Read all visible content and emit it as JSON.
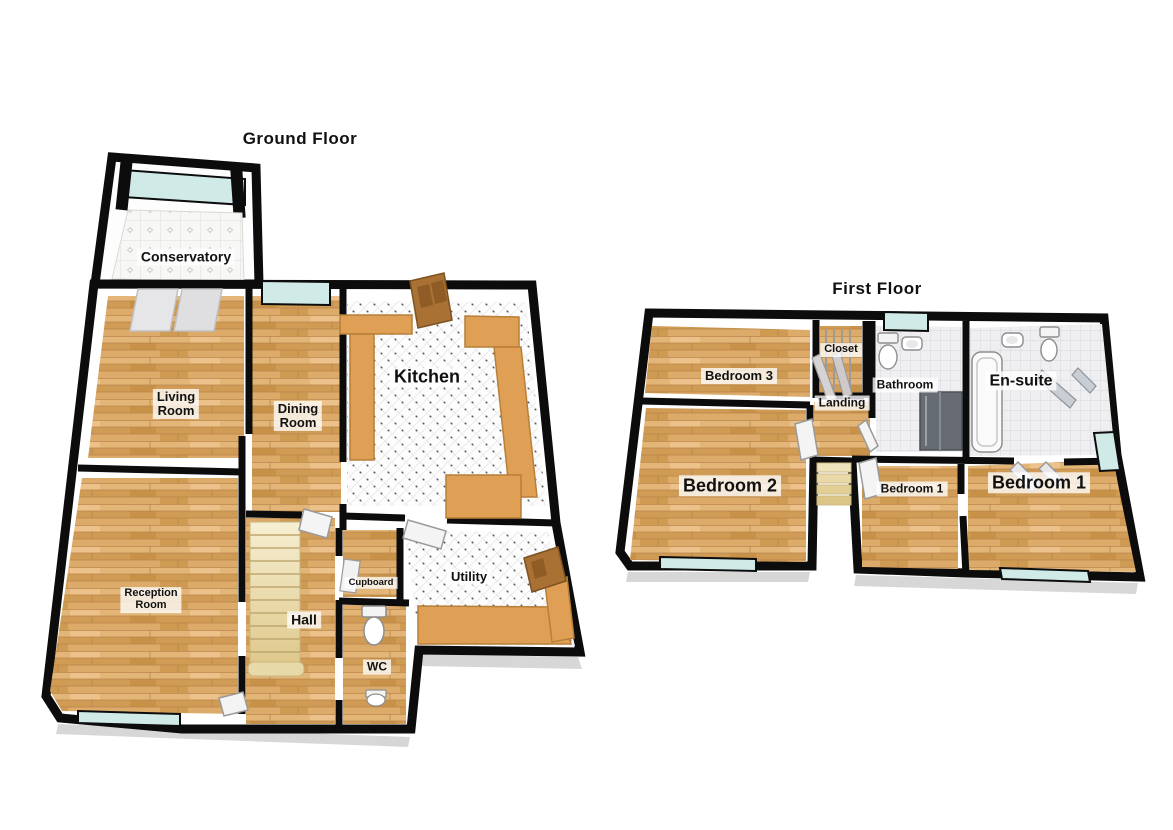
{
  "canvas": {
    "width": 1173,
    "height": 830,
    "background": "#ffffff"
  },
  "floors": [
    {
      "id": "ground-floor",
      "title": "Ground Floor",
      "rooms": [
        {
          "id": "conservatory",
          "label": "Conservatory"
        },
        {
          "id": "living-room",
          "label": "Living\nRoom"
        },
        {
          "id": "dining-room",
          "label": "Dining\nRoom"
        },
        {
          "id": "kitchen",
          "label": "Kitchen"
        },
        {
          "id": "reception-room",
          "label": "Reception\nRoom"
        },
        {
          "id": "hall",
          "label": "Hall"
        },
        {
          "id": "cupboard",
          "label": "Cupboard"
        },
        {
          "id": "wc",
          "label": "WC"
        },
        {
          "id": "utility",
          "label": "Utility"
        }
      ],
      "fixtures": [
        "staircase-icon",
        "toilet-icon",
        "sink-icon",
        "kitchen-counter",
        "utility-counter",
        "door-icon",
        "window-icon",
        "patio-doors-icon"
      ]
    },
    {
      "id": "first-floor",
      "title": "First Floor",
      "rooms": [
        {
          "id": "bedroom-3",
          "label": "Bedroom 3"
        },
        {
          "id": "closet",
          "label": "Closet"
        },
        {
          "id": "bathroom",
          "label": "Bathroom"
        },
        {
          "id": "en-suite",
          "label": "En-suite"
        },
        {
          "id": "landing",
          "label": "Landing"
        },
        {
          "id": "bedroom-2",
          "label": "Bedroom 2"
        },
        {
          "id": "bedroom-1-inner",
          "label": "Bedroom 1"
        },
        {
          "id": "bedroom-1",
          "label": "Bedroom 1"
        }
      ],
      "fixtures": [
        "toilet-icon",
        "sink-icon",
        "shower-icon",
        "bathtub-icon",
        "closet-doors-icon",
        "stairwell-icon",
        "door-icon",
        "window-icon"
      ]
    }
  ],
  "colors": {
    "wall": "#0c0c0c",
    "wood_floor": "#d9a763",
    "tile_floor": "#fdfdfd",
    "window_glass": "#cfeae7",
    "counter": "#dfa055",
    "wood_door": "#a97133",
    "stairs": "#e9d9a8",
    "label_text": "#111111",
    "label_background": "rgba(255,255,255,0.78)"
  }
}
